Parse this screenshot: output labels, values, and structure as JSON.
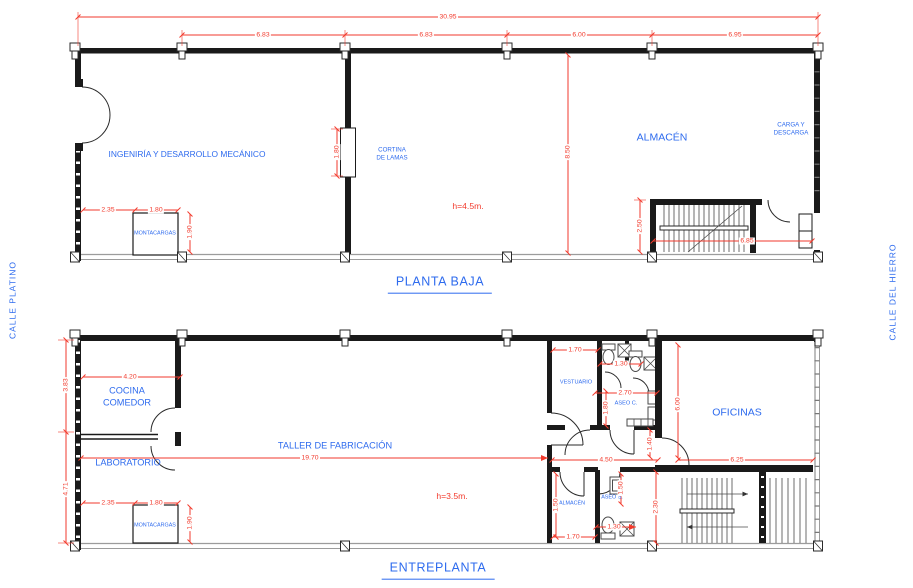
{
  "colors": {
    "wall": "#1a1a1a",
    "glazing": "#9c9c9c",
    "dim_red": "#f23a2c",
    "label_blue": "#2e6bee"
  },
  "streets": {
    "left": "CALLE PLATINO",
    "right": "CALLE DEL HIERRO"
  },
  "planta_baja": {
    "title": "PLANTA BAJA",
    "height_note": "h=4.5m.",
    "rooms": {
      "ingenieria": "INGENIRÍA Y DESARROLLO MECÁNICO",
      "cortina_1": "CORTINA",
      "cortina_2": "DE LAMAS",
      "almacen": "ALMACÉN",
      "carga_1": "CARGA Y",
      "carga_2": "DESCARGA",
      "montacargas": "MONTACARGAS"
    },
    "dims": [
      {
        "t": "30.95",
        "x": 448,
        "y": 17
      },
      {
        "t": "6.83",
        "x": 263,
        "y": 35
      },
      {
        "t": "6.83",
        "x": 426,
        "y": 35
      },
      {
        "t": "6.00",
        "x": 579,
        "y": 35
      },
      {
        "t": "6.95",
        "x": 735,
        "y": 35
      },
      {
        "t": "1.80",
        "x": 337,
        "y": 152,
        "r": 1
      },
      {
        "t": "8.50",
        "x": 568,
        "y": 152,
        "r": 1
      },
      {
        "t": "2.35",
        "x": 108,
        "y": 210
      },
      {
        "t": "1.80",
        "x": 156,
        "y": 210
      },
      {
        "t": "1.90",
        "x": 190,
        "y": 232,
        "r": 1
      },
      {
        "t": "2.50",
        "x": 640,
        "y": 226,
        "r": 1
      },
      {
        "t": "6.85",
        "x": 747,
        "y": 241
      }
    ]
  },
  "entreplanta": {
    "title": "ENTREPLANTA",
    "height_note": "h=3.5m.",
    "rooms": {
      "cocina_1": "COCINA",
      "cocina_2": "COMEDOR",
      "laboratorio": "LABORATORIO",
      "taller": "TALLER DE FABRICACIÓN",
      "vestuario": "VESTUARIO",
      "aseo_c": "ASEO C.",
      "oficinas": "OFICINAS",
      "almacen": "ALMACÉN",
      "aseo_s": "ASEO S.",
      "montacargas": "MONTACARGAS"
    },
    "dims": [
      {
        "t": "3.83",
        "x": 66,
        "y": 385,
        "r": 1
      },
      {
        "t": "4.71",
        "x": 66,
        "y": 489,
        "r": 1
      },
      {
        "t": "4.20",
        "x": 130,
        "y": 377
      },
      {
        "t": "19.70",
        "x": 310,
        "y": 458
      },
      {
        "t": "2.35",
        "x": 108,
        "y": 503
      },
      {
        "t": "1.80",
        "x": 156,
        "y": 503
      },
      {
        "t": "1.90",
        "x": 190,
        "y": 523,
        "r": 1
      },
      {
        "t": "1.70",
        "x": 575,
        "y": 350
      },
      {
        "t": "1.30",
        "x": 621,
        "y": 364
      },
      {
        "t": "2.70",
        "x": 625,
        "y": 393
      },
      {
        "t": "1.80",
        "x": 606,
        "y": 408,
        "r": 1
      },
      {
        "t": "6.00",
        "x": 678,
        "y": 404,
        "r": 1
      },
      {
        "t": "1.40",
        "x": 650,
        "y": 444,
        "r": 1
      },
      {
        "t": "4.50",
        "x": 606,
        "y": 460
      },
      {
        "t": "6.25",
        "x": 737,
        "y": 460
      },
      {
        "t": "1.50",
        "x": 556,
        "y": 505,
        "r": 1
      },
      {
        "t": "1.50",
        "x": 621,
        "y": 488,
        "r": 1
      },
      {
        "t": "1.30",
        "x": 614,
        "y": 527
      },
      {
        "t": "1.70",
        "x": 573,
        "y": 537
      },
      {
        "t": "2.30",
        "x": 656,
        "y": 507,
        "r": 1
      }
    ]
  }
}
